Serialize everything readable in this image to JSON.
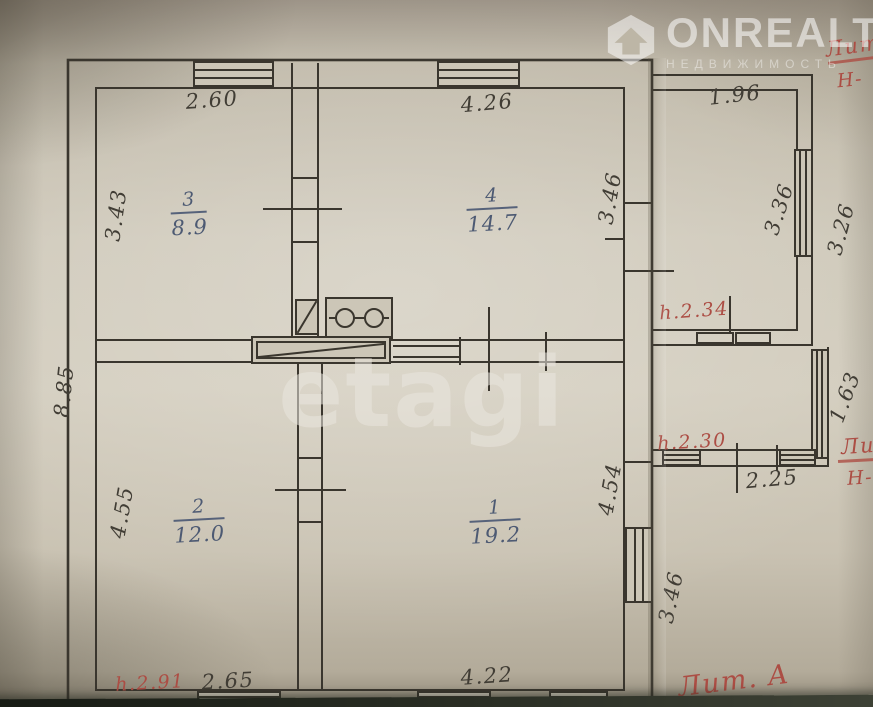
{
  "watermarks": {
    "brand": "ONREALT",
    "brand_subtitle": "НЕДВИЖИМОСТЬ",
    "etagi": "etagi"
  },
  "rooms": [
    {
      "number": "3",
      "area": "8.9"
    },
    {
      "number": "4",
      "area": "14.7"
    },
    {
      "number": "2",
      "area": "12.0"
    },
    {
      "number": "1",
      "area": "19.2"
    }
  ],
  "dimensions": {
    "room3_top": "2.60",
    "room4_top": "4.26",
    "annex_top": "1.96",
    "room3_left": "3.43",
    "room4_right": "3.46",
    "annex_right_inner": "3.36",
    "annex_right_outer": "3.26",
    "house_left": "8.85",
    "room2_left": "4.55",
    "room1_right": "4.54",
    "house_right_lower": "3.46",
    "porch_right": "1.63",
    "porch_bottom": "2.25",
    "room2_bottom": "2.65",
    "room1_bottom": "4.22"
  },
  "red_annotations": {
    "top_right_label": "Лит",
    "top_right_height": "Н-",
    "annex_height": "h.2.34",
    "porch_height": "h.2.30",
    "house_height": "h.2.91",
    "mid_right_label": "Ли",
    "mid_right_height": "Н-",
    "litera": "Лит. А"
  },
  "colors": {
    "ink": "#3a362e",
    "blue_ink": "#4d5a73",
    "red_ink": "#ac4d44",
    "paper": "#ccc6b7"
  }
}
